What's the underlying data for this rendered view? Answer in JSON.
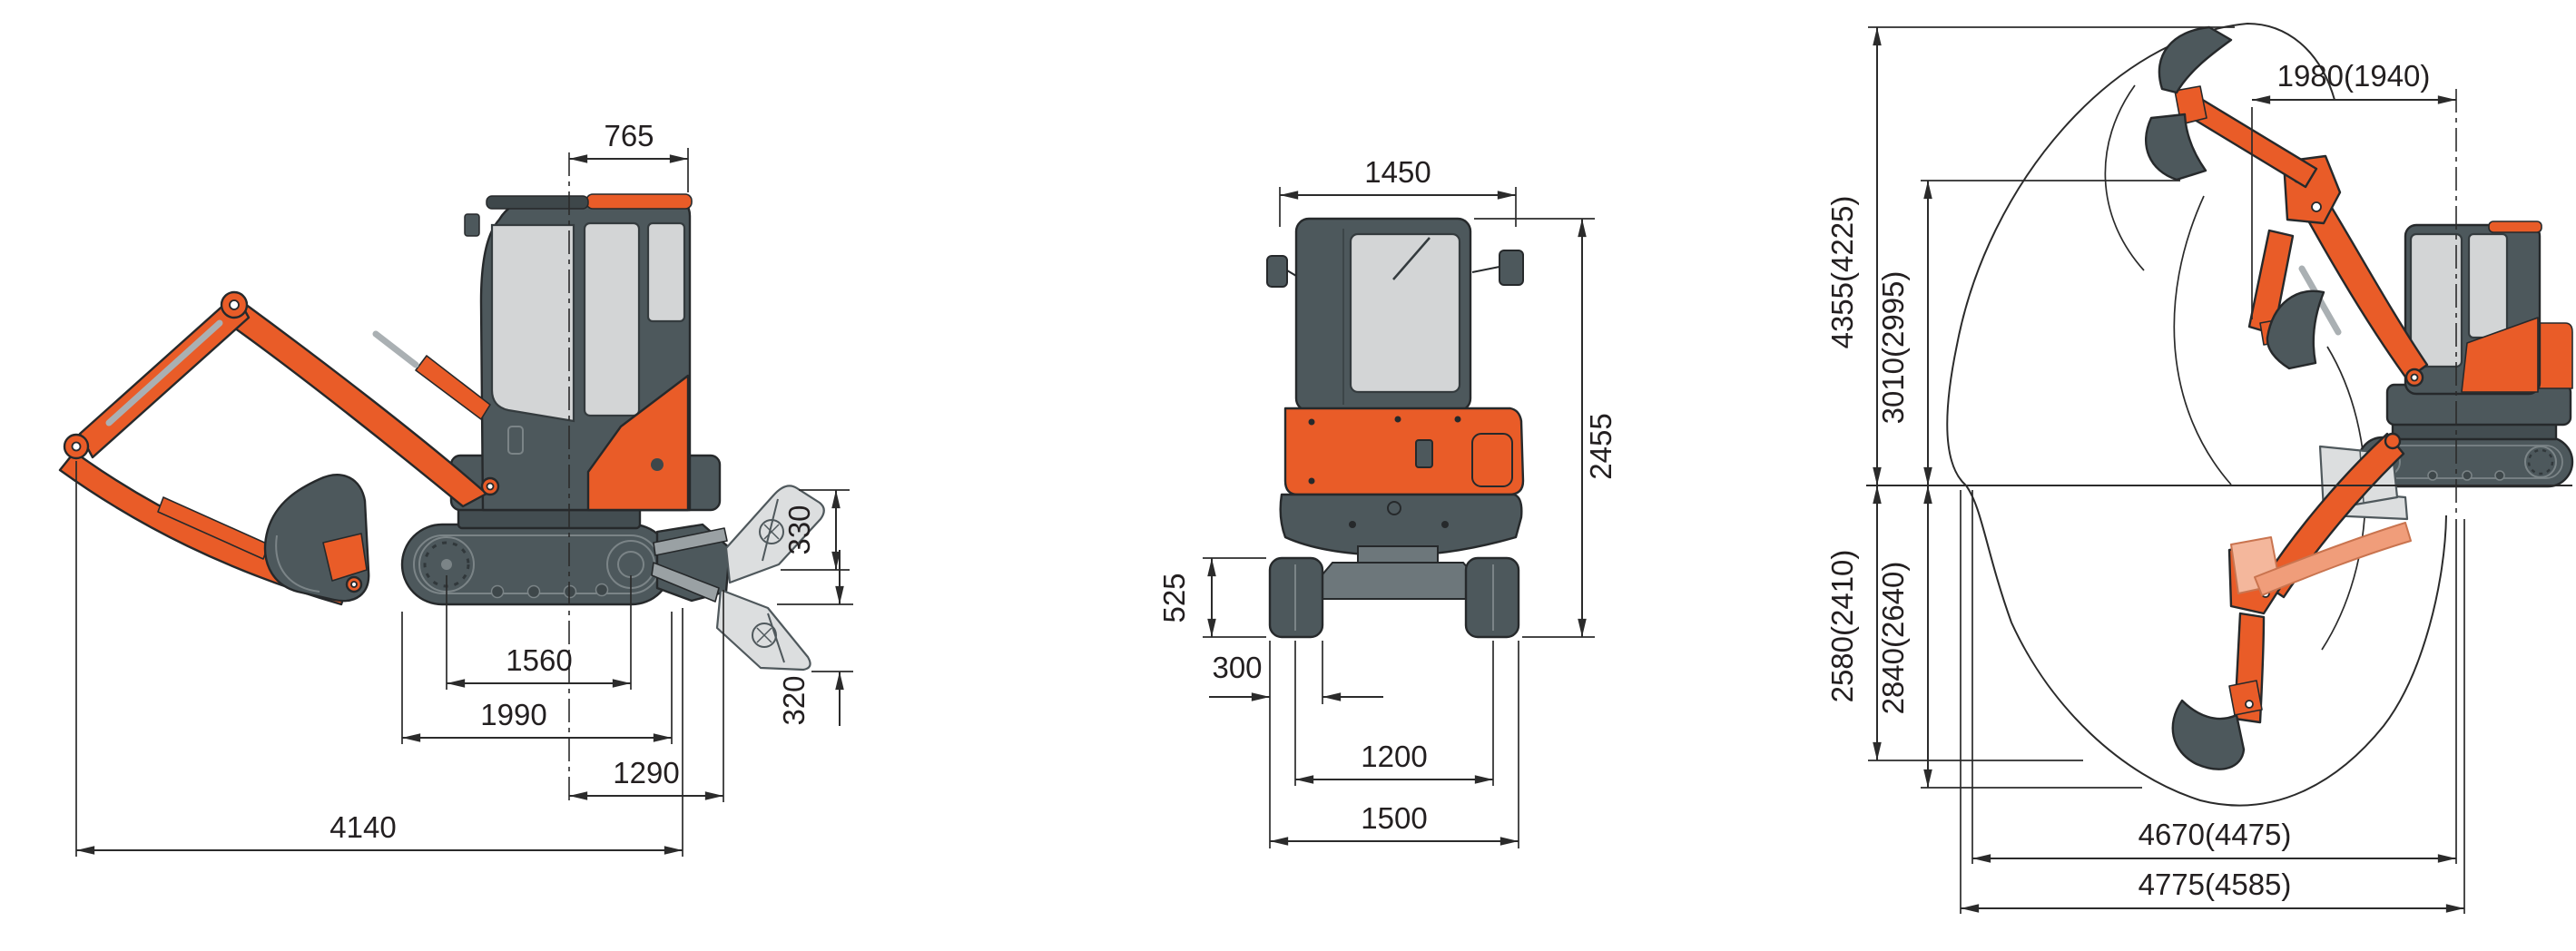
{
  "colors": {
    "machine_orange": "#e95c28",
    "machine_dark_gray": "#4d585c",
    "window_gray": "#d3d5d6",
    "blade_light_gray": "#dcdedf",
    "option_arm_salmon": "#f09d7a",
    "dimension_line": "#2b2b2b",
    "background": "#ffffff"
  },
  "side_view": {
    "dims": {
      "upper_structure_width": "765",
      "blade_lift_height": "330",
      "blade_cut_depth": "320",
      "tumbler_distance": "1560",
      "crawler_length": "1990",
      "swing_center_to_blade": "1290",
      "overall_length": "4140"
    }
  },
  "rear_view": {
    "dims": {
      "upper_body_width": "1450",
      "overall_height": "2455",
      "crawler_height": "525",
      "shoe_width": "300",
      "track_gauge": "1200",
      "overall_width": "1500"
    }
  },
  "working_range": {
    "dims": {
      "front_swing_radius": "1980(1940)",
      "max_cutting_height": "4355(4225)",
      "max_dumping_height": "3010(2995)",
      "max_digging_depth": "2580(2410)",
      "max_vertical_digging_depth": "2840(2640)",
      "digging_reach_at_ground": "4670(4475)",
      "max_digging_reach": "4775(4585)"
    }
  }
}
